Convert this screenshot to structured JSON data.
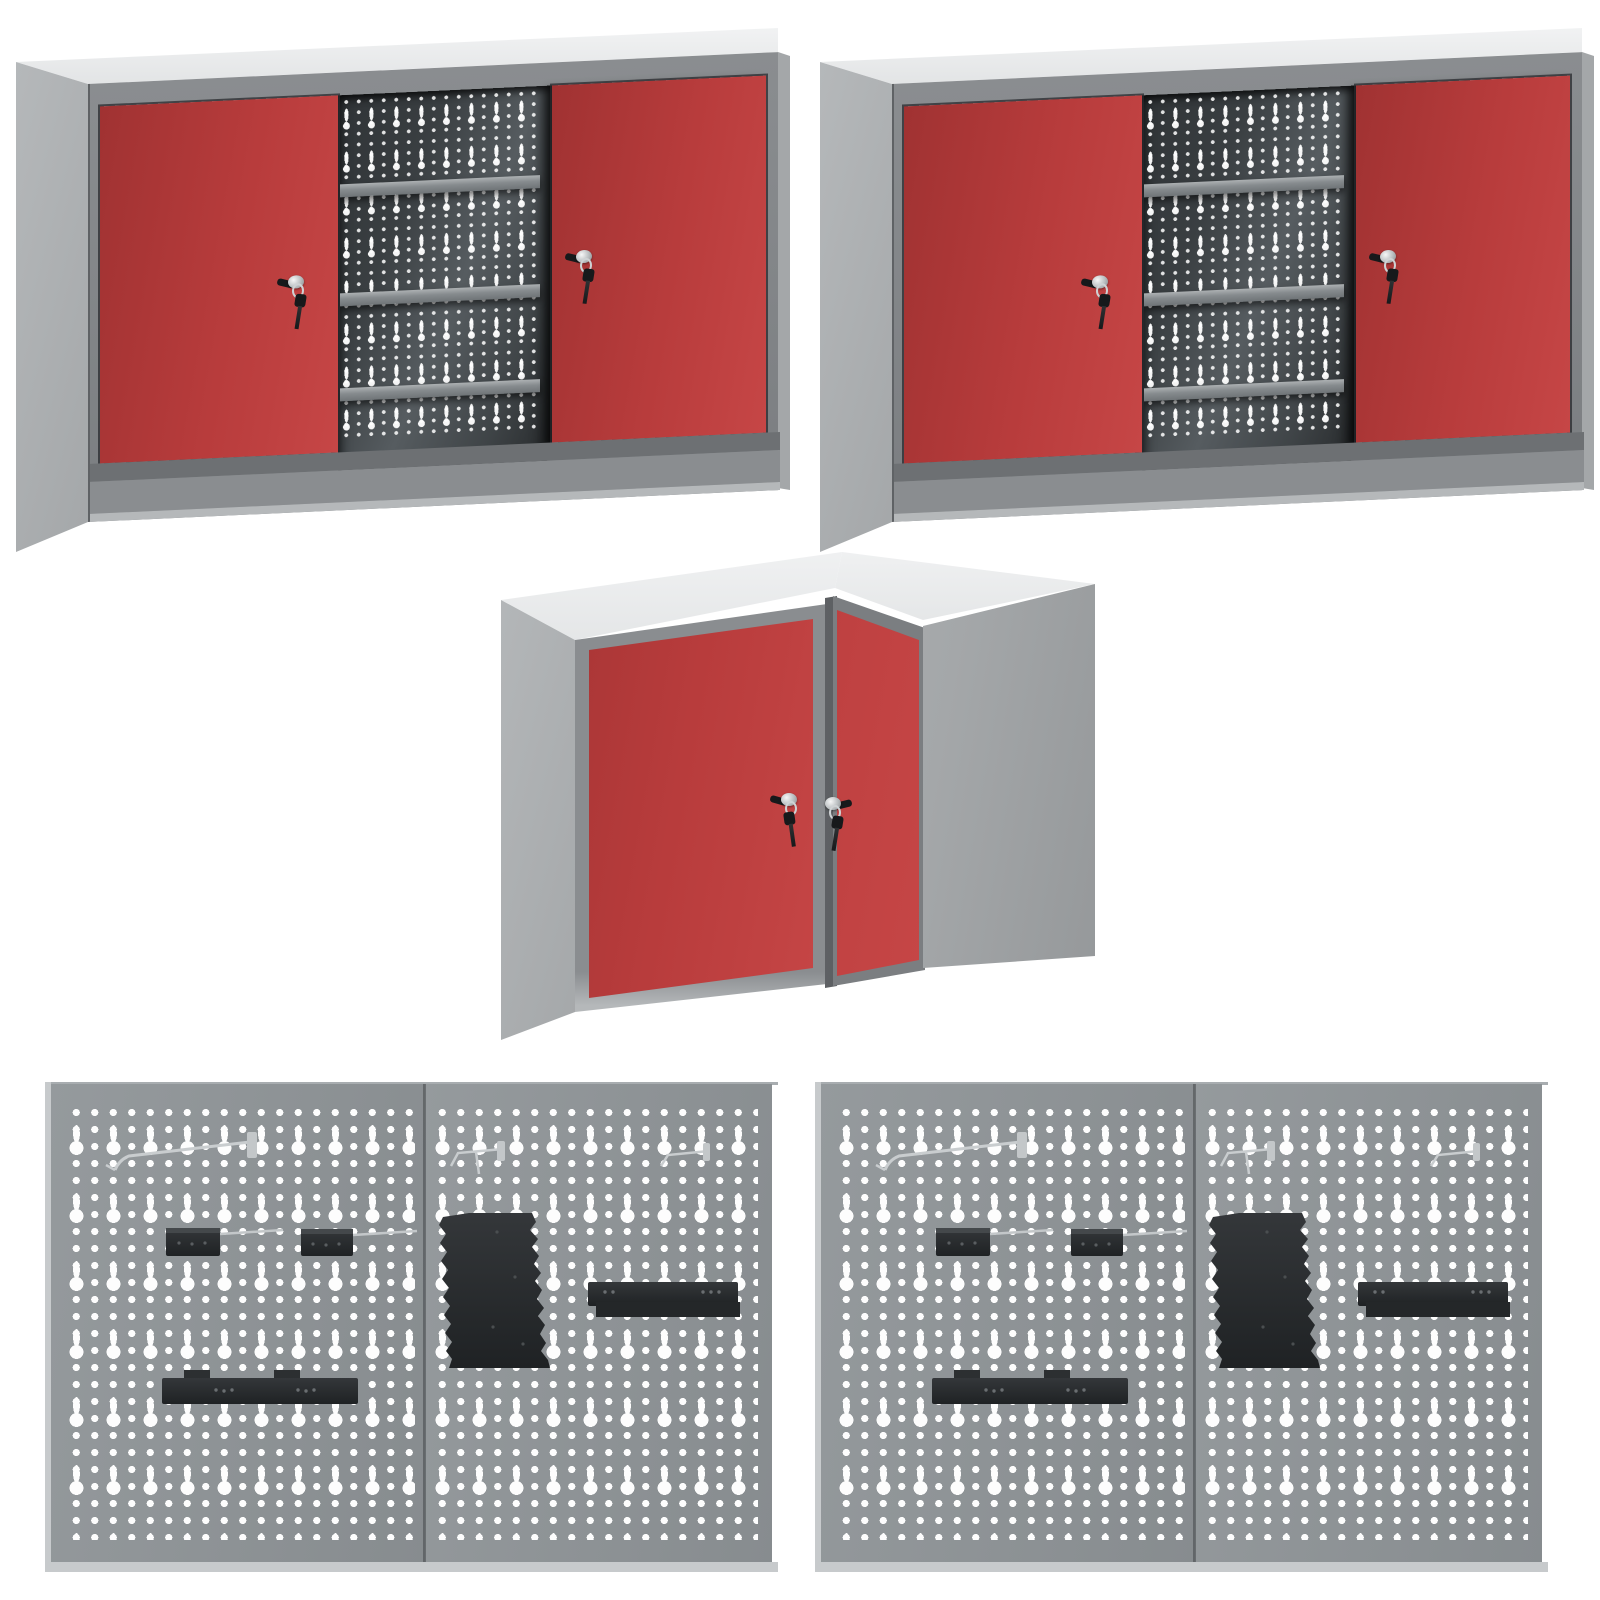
{
  "page": {
    "background": "#ffffff",
    "canvas": {
      "width": 1600,
      "height": 1600
    },
    "description": "Product collage on white background: two identical metal wall cabinets with red sliding doors and perforated interior back panels, one corner wall cabinet with two red lockable doors, and two identical perforated pegboard wall panel sets with black tool holders"
  },
  "colors": {
    "background": "#ffffff",
    "red": "#b83c3c",
    "red_dark": "#a03232",
    "red_light": "#c64646",
    "frame": "#8a8d90",
    "frame_dark": "#7b7e81",
    "track": "#6d7073",
    "side": "#b5b8ba",
    "side_dark": "#a4a7a9",
    "top_light": "#e2e4e5",
    "top_lighter": "#f1f2f3",
    "interior_dark": "#2f3336",
    "interior_mid": "#565c60",
    "shelf": "#868b8e",
    "shelf_light": "#adb1b3",
    "panel": "#878c8f",
    "panel_light": "#959a9d",
    "hole_white": "#fdfdfd",
    "edge_light": "#c7cacc",
    "accessory_black": "#2b2e30",
    "accessory_black_dark": "#1f2224",
    "silver_wire": "#ced2d4",
    "key_black": "#17191b"
  },
  "scene": {
    "items": [
      {
        "template": "wall-cabinet",
        "name": "wall-cabinet-top-left",
        "x": 8,
        "y": 22,
        "w": 784,
        "h": 534
      },
      {
        "template": "wall-cabinet",
        "name": "wall-cabinet-top-right",
        "x": 812,
        "y": 22,
        "w": 784,
        "h": 534
      },
      {
        "template": "corner-cabinet",
        "name": "corner-cabinet-middle",
        "x": 495,
        "y": 540,
        "w": 610,
        "h": 502
      },
      {
        "template": "pegboard-set",
        "name": "pegboard-set-bottom-left",
        "x": 45,
        "y": 1082,
        "w": 733,
        "h": 490
      },
      {
        "template": "pegboard-set",
        "name": "pegboard-set-bottom-right",
        "x": 815,
        "y": 1082,
        "w": 733,
        "h": 490
      }
    ],
    "wall_cabinet": {
      "doors": 2,
      "door_color": "red",
      "door_type": "sliding",
      "locks": 2,
      "keys_hanging_per_lock": 1,
      "shelves_visible": 3,
      "back_panel": "dark perforated pegboard with keyhole slots"
    },
    "corner_cabinet": {
      "shape": "L-corner",
      "doors": 2,
      "door_color": "red",
      "locks": 2,
      "keys_hanging_per_lock": 1
    },
    "pegboard_set": {
      "panels": 2,
      "panel_color": "grey",
      "hole_pattern": "keyhole slots and round holes",
      "accessories": [
        "wire-hook-large",
        "wire-hook-small",
        "wire-hook-small",
        "small-bracket",
        "small-bracket",
        "serrated-tool-holder",
        "tool-holder-bar",
        "shelf-bracket"
      ],
      "accessory_color": "black"
    }
  }
}
